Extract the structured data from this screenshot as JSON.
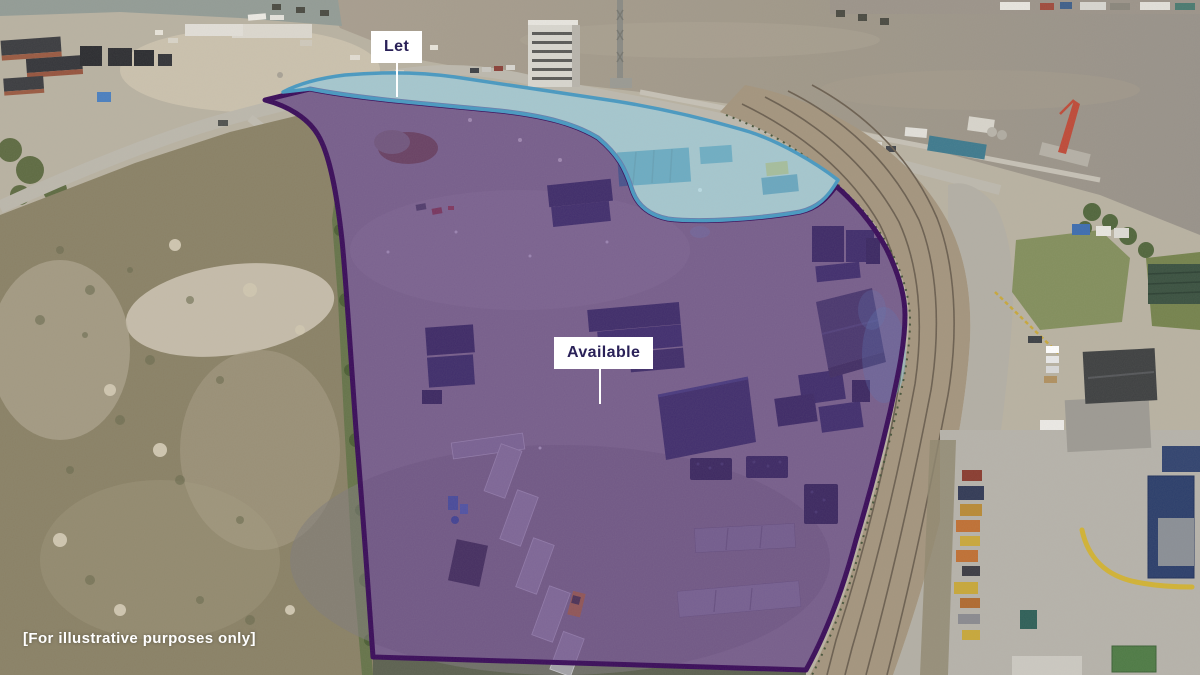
{
  "page": {
    "type": "aerial-letting-plan",
    "disclaimer": "[For illustrative purposes only]"
  },
  "regions": {
    "let": {
      "label": "Let",
      "fill": "rgba(150,214,235,0.55)",
      "border": "#4899c2"
    },
    "available": {
      "label": "Available",
      "fill": "rgba(88,42,133,0.5)",
      "border": "#3a0c5a"
    }
  },
  "label_style": {
    "background": "#ffffff",
    "text_color": "#2a2158",
    "leader_color": "#ffffff"
  }
}
